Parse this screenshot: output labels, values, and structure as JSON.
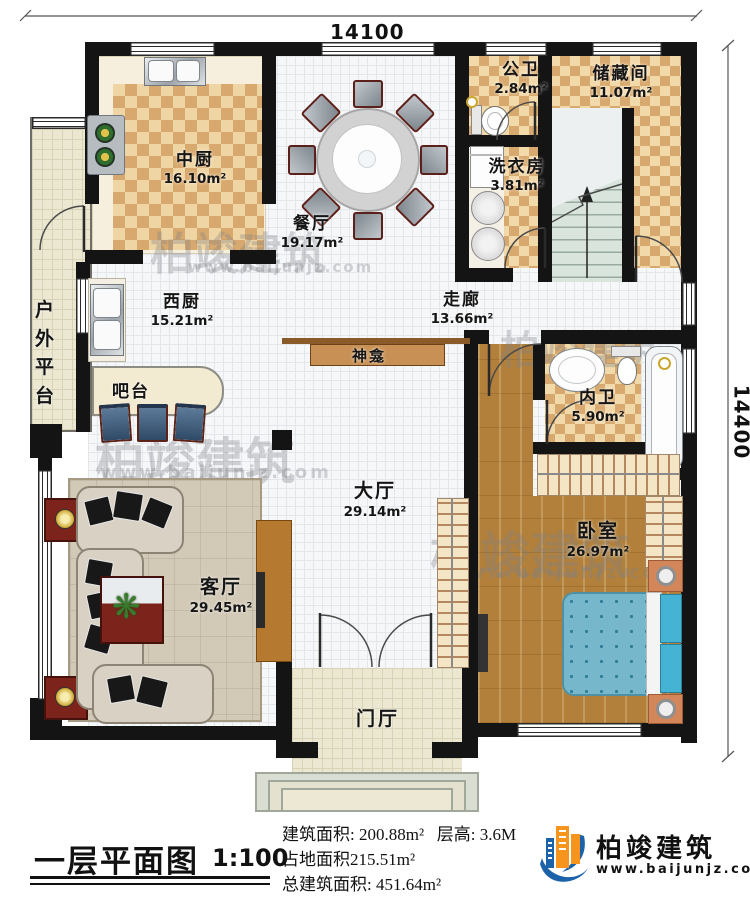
{
  "plan": {
    "dimensions": {
      "top": "14100",
      "right": "14400"
    },
    "rooms": [
      {
        "name": "中厨",
        "area": "16.10m²"
      },
      {
        "name": "餐厅",
        "area": "19.17m²"
      },
      {
        "name": "公卫",
        "area": "2.84m²"
      },
      {
        "name": "储藏间",
        "area": "11.07m²"
      },
      {
        "name": "洗衣房",
        "area": "3.81m²"
      },
      {
        "name": "走廊",
        "area": "13.66m²"
      },
      {
        "name": "西厨",
        "area": "15.21m²"
      },
      {
        "name": "内卫",
        "area": "5.90m²"
      },
      {
        "name": "大厅",
        "area": "29.14m²"
      },
      {
        "name": "客厅",
        "area": "29.45m²"
      },
      {
        "name": "卧室",
        "area": "26.97m²"
      }
    ],
    "labels": {
      "outdoor_platform": "户外平台",
      "bar": "吧台",
      "shrine": "神龛",
      "foyer": "门厅"
    }
  },
  "title_block": {
    "title": "一层平面图",
    "scale": "1:100",
    "stat1a": "建筑面积: 200.88m²",
    "stat1b": "层高: 3.6M",
    "stat2": "占地面积215.51m²",
    "stat3": "总建筑面积: 451.64m²"
  },
  "logo": {
    "name": "柏竣建筑",
    "url": "www.baijunjz.com"
  },
  "watermark": {
    "brand": "柏竣建筑",
    "url": "www.baijunjz.com"
  }
}
